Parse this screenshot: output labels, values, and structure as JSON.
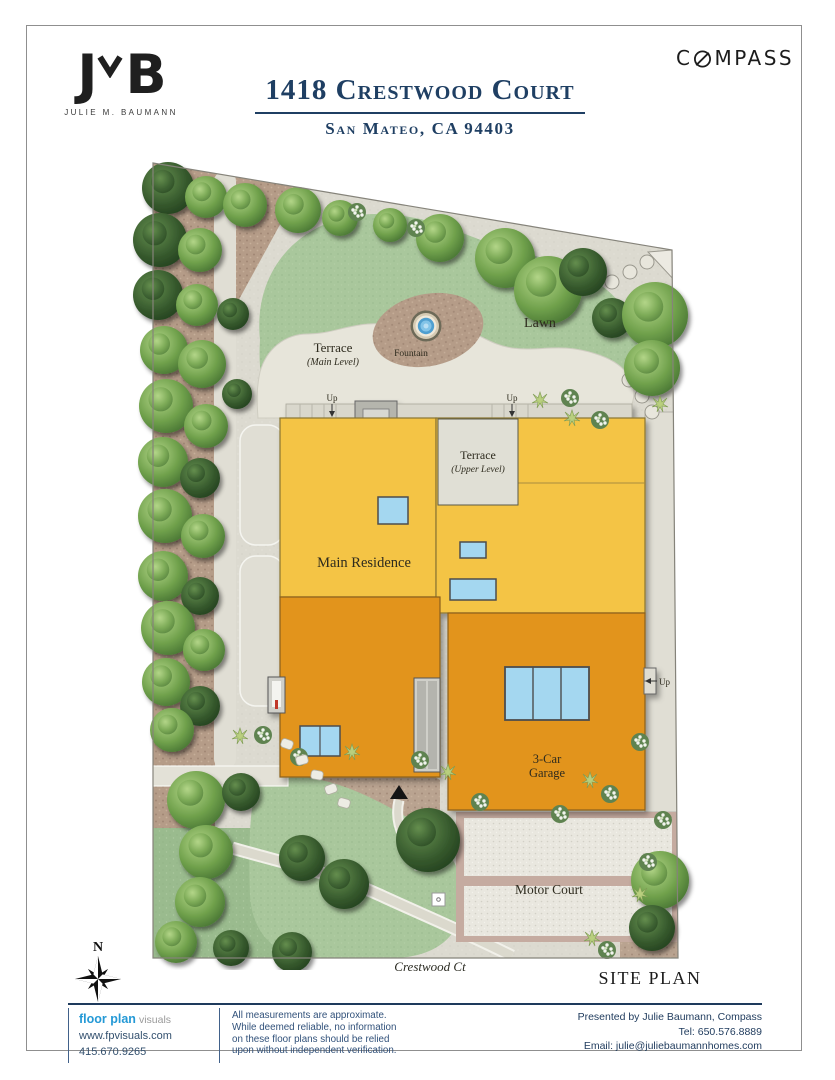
{
  "header": {
    "logo_left": "J",
    "logo_right": "B",
    "logo_name": "JULIE M. BAUMANN",
    "title": "1418 Crestwood Court",
    "subtitle": "San Mateo, CA 94403",
    "brand_c": "C",
    "brand_rest": "MPASS"
  },
  "plan": {
    "labels": {
      "lawn": "Lawn",
      "terrace_main": "Terrace",
      "terrace_main_sub": "(Main Level)",
      "fountain": "Fountain",
      "terrace_upper": "Terrace",
      "terrace_upper_sub": "(Upper Level)",
      "main_residence": "Main Residence",
      "garage_line1": "3-Car",
      "garage_line2": "Garage",
      "motor_court": "Motor Court",
      "up": "Up"
    },
    "north_indicator": "N",
    "street_name": "Crestwood Ct",
    "sheet_title": "SITE PLAN"
  },
  "footer": {
    "brand_blue": "floor plan",
    "brand_gray": "visuals",
    "website": "www.fpvisuals.com",
    "phone": "415.670.9265",
    "disclaimer_lines": [
      "All measurements are approximate.",
      "While deemed reliable, no information",
      "on these floor plans should be relied",
      "upon without independent verification."
    ],
    "presented_by": "Presented by Julie Baumann, Compass",
    "tel": "Tel: 650.576.8889",
    "email": "Email: julie@juliebaumannhomes.com"
  },
  "colors": {
    "accent_navy": "#1e3a5c",
    "footer_blue": "#2499d6",
    "residence_yellow": "#f4c445",
    "garage_orange": "#e2941e",
    "lawn_green": "#a9c79c",
    "terrace_gray": "#e7e5da",
    "mulch_brown": "#b59c88",
    "window_blue": "#a4d7f0"
  }
}
